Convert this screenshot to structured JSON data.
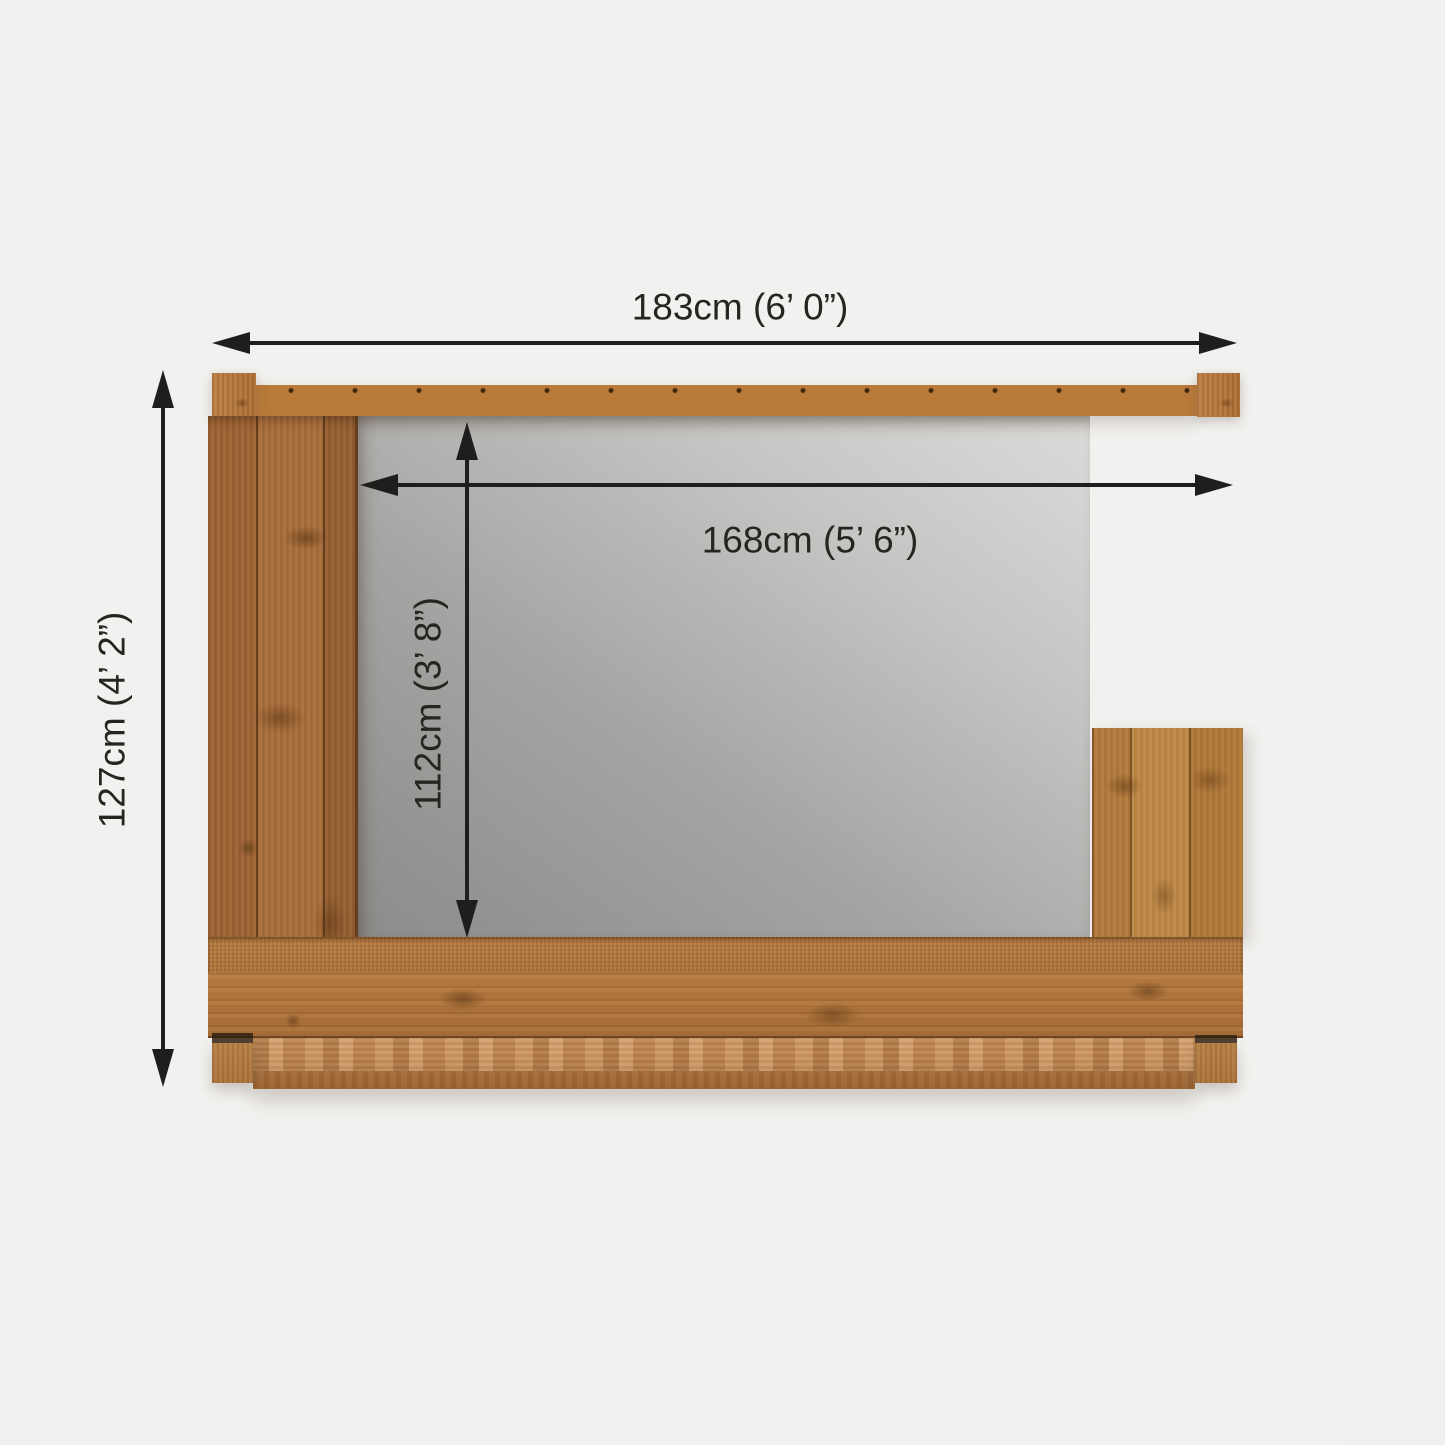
{
  "diagram": {
    "kind": "product-plan-view-dimension-diagram",
    "dimensions": {
      "outer_width": "183cm (6’ 0”)",
      "inner_width": "168cm (5’ 6”)",
      "outer_depth": "127cm (4’ 2”)",
      "inner_depth": "112cm (3’ 8”)"
    },
    "colors": {
      "arrow": "#1f1e1c",
      "text": "#262522",
      "wood_mid": "#a96e3a",
      "wood_light": "#c68f5c",
      "wood_dark": "#69401d",
      "glass_gray": "#a5a4a2",
      "background": "#f1f0ee"
    }
  }
}
